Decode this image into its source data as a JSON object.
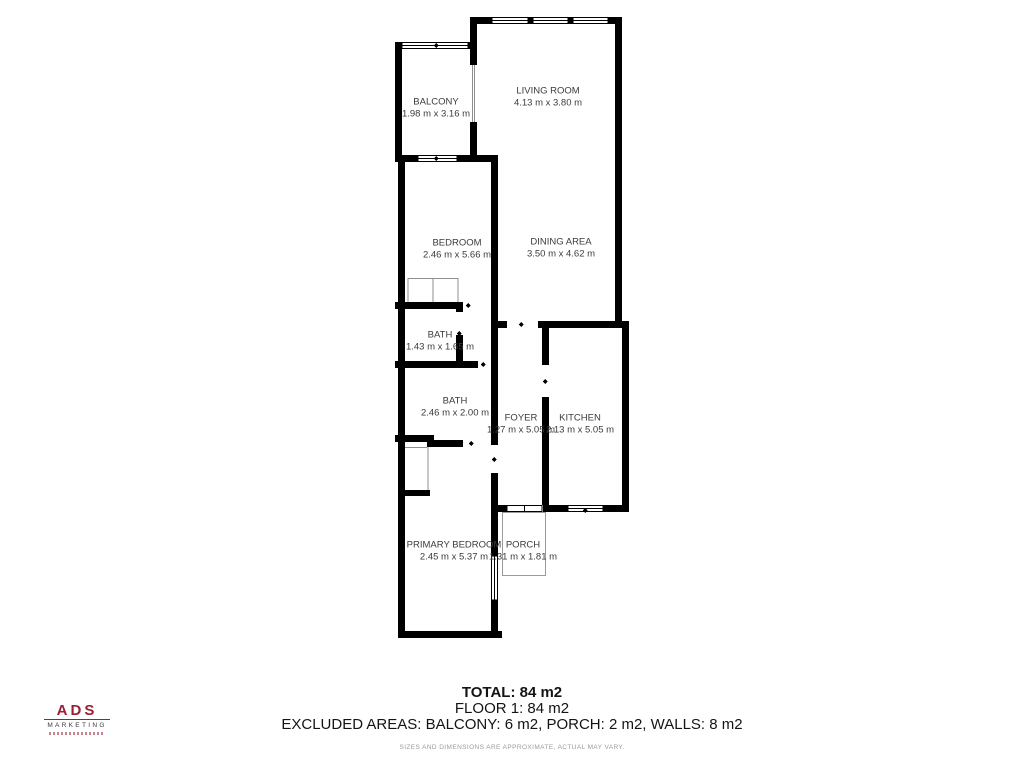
{
  "rooms": [
    {
      "name": "BALCONY",
      "dims": "1.98 m x 3.16 m",
      "cx": 436,
      "cy": 108
    },
    {
      "name": "LIVING ROOM",
      "dims": "4.13 m x 3.80 m",
      "cx": 548,
      "cy": 97
    },
    {
      "name": "BEDROOM",
      "dims": "2.46 m x 5.66 m",
      "cx": 457,
      "cy": 249
    },
    {
      "name": "DINING AREA",
      "dims": "3.50 m x 4.62 m",
      "cx": 561,
      "cy": 248
    },
    {
      "name": "BATH",
      "dims": "1.43 m x 1.65 m",
      "cx": 440,
      "cy": 341
    },
    {
      "name": "BATH",
      "dims": "2.46 m x 2.00 m",
      "cx": 455,
      "cy": 407
    },
    {
      "name": "FOYER",
      "dims": "1.27 m x 5.05 m",
      "cx": 521,
      "cy": 424
    },
    {
      "name": "KITCHEN",
      "dims": "2.13 m x 5.05 m",
      "cx": 580,
      "cy": 424
    },
    {
      "name": "PRIMARY BEDROOM",
      "dims": "2.45 m x 5.37 m",
      "cx": 454,
      "cy": 551
    },
    {
      "name": "PORCH",
      "dims": "1.31 m x 1.81 m",
      "cx": 523,
      "cy": 551
    }
  ],
  "footer": {
    "total": "TOTAL: 84 m2",
    "floor": "FLOOR 1: 84 m2",
    "excluded": "EXCLUDED AREAS: BALCONY: 6 m2, PORCH: 2 m2, WALLS: 8 m2",
    "disclaimer": "SIZES AND DIMENSIONS ARE APPROXIMATE, ACTUAL MAY VARY."
  },
  "logo": {
    "name": "ADS",
    "subtitle": "MARKETING"
  },
  "colors": {
    "wall": "#000000",
    "thin_line": "#8f8f8f",
    "label_text": "#3b3b3b",
    "footer_text": "#141414",
    "disclaimer_text": "#9b9b9b",
    "logo_red": "#9b1e33"
  }
}
